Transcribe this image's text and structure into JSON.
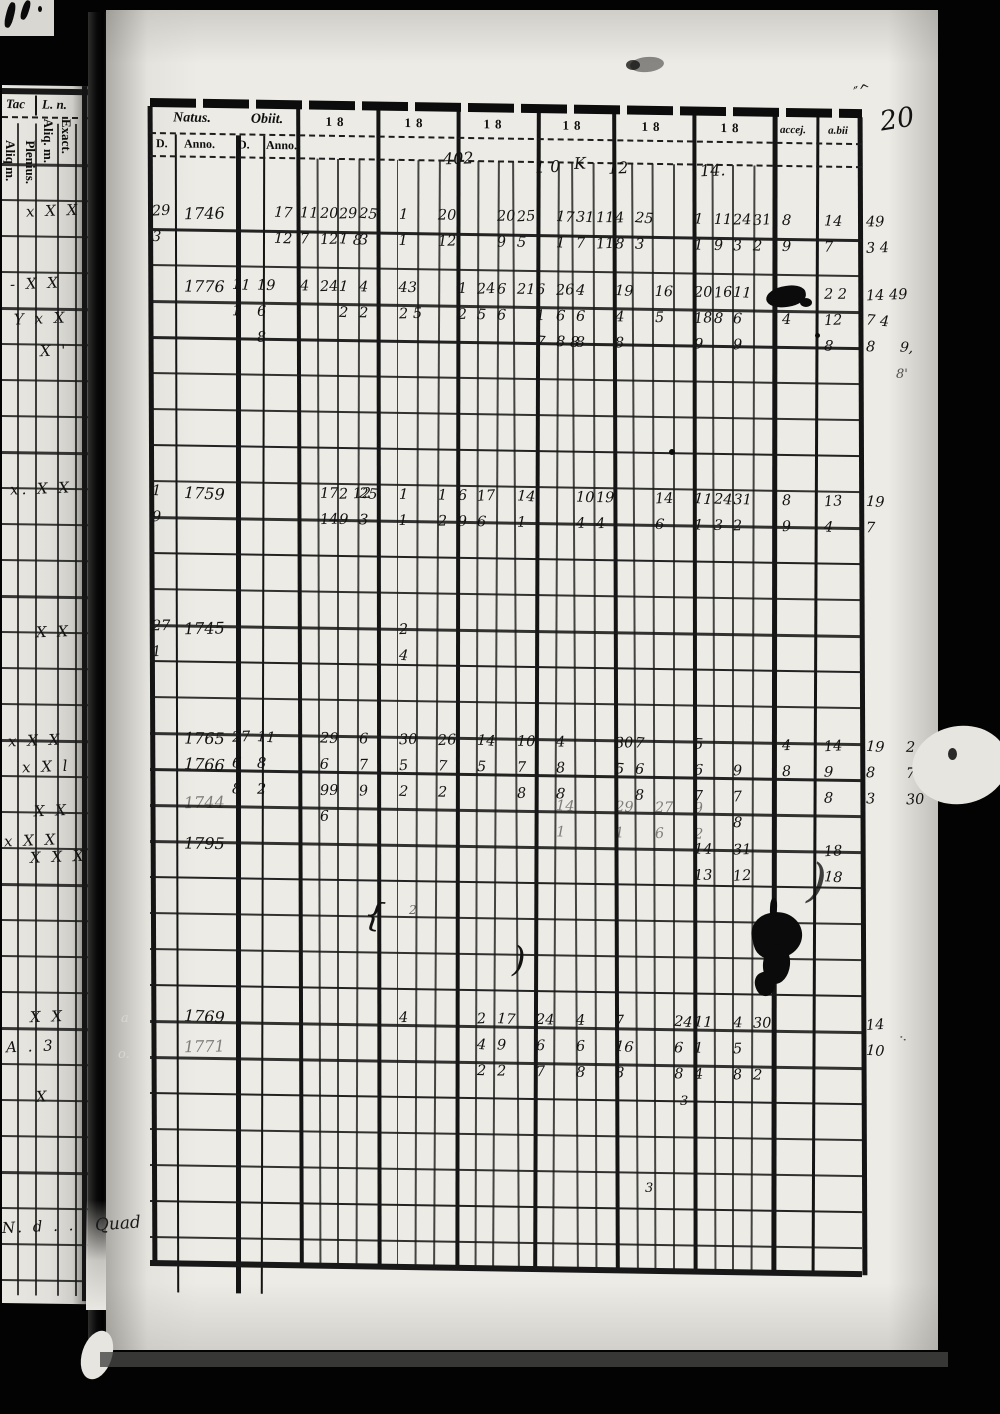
{
  "film": {
    "page_number": "20"
  },
  "left_strip": {
    "header_tac": "Tac",
    "header_ln": "L. n.",
    "rotated_labels": [
      {
        "t": "Exact.",
        "x": 72,
        "y": 33
      },
      {
        "t": "Aliq. m.",
        "x": 54,
        "y": 33
      },
      {
        "t": "Plenius.",
        "x": 36,
        "y": 55
      },
      {
        "t": "Aliq m.",
        "x": 16,
        "y": 55
      }
    ],
    "x_mark_rows": [
      {
        "y": 127,
        "x": 24,
        "t": "x X X"
      },
      {
        "y": 200,
        "x": 8,
        "t": "- X X"
      },
      {
        "y": 235,
        "x": 12,
        "t": "Y x X"
      },
      {
        "y": 267,
        "x": 38,
        "t": "X '"
      },
      {
        "y": 405,
        "x": 8,
        "t": "x. X X"
      },
      {
        "y": 548,
        "x": 34,
        "t": "X X"
      },
      {
        "y": 657,
        "x": 6,
        "t": "x X X"
      },
      {
        "y": 683,
        "x": 20,
        "t": "x X l"
      },
      {
        "y": 727,
        "x": 32,
        "t": "X X"
      },
      {
        "y": 757,
        "x": 2,
        "t": "x X X"
      },
      {
        "y": 773,
        "x": 28,
        "t": "X X X"
      },
      {
        "y": 933,
        "x": 28,
        "t": "X X"
      },
      {
        "y": 963,
        "x": 4,
        "t": "A . 3"
      },
      {
        "y": 1013,
        "x": 34,
        "t": "X"
      },
      {
        "y": 1143,
        "x": 0,
        "t": "N. d . ."
      }
    ],
    "gutter_word": "Quad",
    "gutter_marks": [
      {
        "g": "a",
        "x": 121,
        "y": 1012
      },
      {
        "g": "o.",
        "x": 118,
        "y": 1048
      }
    ]
  },
  "table": {
    "header": {
      "natus": "Natus.",
      "obiit": "Obiit.",
      "d1": "D.",
      "anno1": "Anno.",
      "d2": "D.",
      "anno2": "Anno.",
      "year_cols": [
        "18",
        "18",
        "18",
        "18",
        "18",
        "18"
      ],
      "accej": "accej.",
      "abii": "a.bii"
    },
    "top_annotations": [
      {
        "t": "402",
        "x": 293,
        "y": 48
      },
      {
        "t": "1 0",
        "x": 385,
        "y": 55
      },
      {
        "t": "K",
        "x": 424,
        "y": 51
      },
      {
        "t": "12",
        "x": 458,
        "y": 55
      },
      {
        "t": "14.",
        "x": 550,
        "y": 56
      }
    ],
    "rows": [
      {
        "year": "1746",
        "y": 117,
        "cells": {
          "nD": [
            "29",
            "3"
          ],
          "oA2": [
            "17",
            "12"
          ],
          "s0": [
            "11",
            "7"
          ],
          "s1": [
            "20",
            "12"
          ],
          "s2": [
            "29",
            "1 8"
          ],
          "s3": [
            "25",
            "3"
          ],
          "s5": [
            "1",
            "1"
          ],
          "s7": [
            "20",
            "12"
          ],
          "s10": [
            "20",
            "9"
          ],
          "s11": [
            "25",
            "5"
          ],
          "s13": [
            "17",
            "1"
          ],
          "s14": [
            "31",
            "7"
          ],
          "s15": [
            "11",
            "11"
          ],
          "s16": [
            "4",
            "8"
          ],
          "s17": [
            "25",
            "3"
          ],
          "s20": [
            "1",
            "1"
          ],
          "s21": [
            "11",
            "9"
          ],
          "s22": [
            "24",
            "3"
          ],
          "s23": [
            "31",
            "2"
          ],
          "ac": [
            "8",
            "9"
          ],
          "ab": [
            "14",
            "7"
          ],
          "mR": [
            "49",
            "3 4"
          ]
        }
      },
      {
        "year": "1776",
        "y": 190,
        "cells": {
          "oD": [
            "11",
            "1"
          ],
          "oA": [
            "19",
            "6",
            "8"
          ],
          "s0": [
            "4",
            ""
          ],
          "s1": [
            "24",
            ""
          ],
          "s2": [
            "1",
            "2"
          ],
          "s3": [
            "4",
            "2"
          ],
          "s5": [
            "43",
            "2 5"
          ],
          "s8": [
            "1",
            "2"
          ],
          "s9": [
            "24",
            "5"
          ],
          "s10": [
            "6",
            "6"
          ],
          "s11": [
            "21",
            ""
          ],
          "s12": [
            "6",
            "1",
            "7"
          ],
          "s13": [
            "26",
            "6",
            "8 8"
          ],
          "s14": [
            "4",
            "6",
            "8"
          ],
          "s16": [
            "19",
            "4",
            "8"
          ],
          "s18": [
            "16",
            "5"
          ],
          "s20": [
            "20",
            "18",
            "9"
          ],
          "s21": [
            "16",
            "8"
          ],
          "s22": [
            "11",
            "6",
            "9"
          ],
          "ac": [
            "",
            "4"
          ],
          "ab": [
            "2 2",
            "12",
            "8"
          ],
          "mR": [
            "14 49",
            "7 4",
            "8"
          ]
        }
      },
      {
        "year": "1759",
        "y": 397,
        "cells": {
          "nD": [
            "1",
            "9"
          ],
          "s1": [
            "17",
            "14"
          ],
          "s2": [
            "2 12",
            "9"
          ],
          "s3": [
            "25",
            "3"
          ],
          "s5": [
            "1",
            "1"
          ],
          "s7": [
            "1",
            "2"
          ],
          "s8": [
            "6",
            "9"
          ],
          "s9": [
            "17",
            "6"
          ],
          "s11": [
            "14",
            "1"
          ],
          "s14": [
            "10",
            "4"
          ],
          "s15": [
            "19",
            "4"
          ],
          "s18": [
            "14",
            "6"
          ],
          "s20": [
            "11",
            "1"
          ],
          "s21": [
            "24",
            "3"
          ],
          "s22": [
            "31",
            "2"
          ],
          "ac": [
            "8",
            "9"
          ],
          "ab": [
            "13",
            "4"
          ],
          "mR": [
            "19",
            "7"
          ]
        }
      },
      {
        "year": "1745",
        "y": 532,
        "cells": {
          "nD": [
            "27",
            "1"
          ],
          "s5": [
            "2",
            "4"
          ]
        }
      },
      {
        "year": "1765",
        "y": 642,
        "cells": {
          "oD": [
            "27",
            "6",
            "8"
          ],
          "oA": [
            "11",
            "8",
            "2"
          ],
          "s1": [
            "29",
            "6",
            "99",
            "6"
          ],
          "s3": [
            "6",
            "7",
            "9"
          ],
          "s5": [
            "30",
            "5",
            "2"
          ],
          "s7": [
            "26",
            "7",
            "2"
          ],
          "s9": [
            "14",
            "5"
          ],
          "s11": [
            "10",
            "7",
            "8"
          ],
          "s13": [
            "4",
            "8",
            "8"
          ],
          "s16": [
            "30",
            "5"
          ],
          "s17": [
            "7",
            "6",
            "8"
          ],
          "s20": [
            "5",
            "6",
            "7"
          ],
          "s22": [
            "",
            "9",
            "7",
            "8"
          ],
          "ac": [
            "4",
            "8"
          ],
          "ab": [
            "14",
            "9",
            "8"
          ],
          "mR": [
            "19",
            "8",
            "3"
          ],
          "mR2": [
            "2",
            "7",
            "30"
          ]
        }
      },
      {
        "year": "1766",
        "y": 668,
        "cells": {}
      },
      {
        "year": "1744",
        "y": 706,
        "faint": true,
        "cells": {
          "s13": [
            "14",
            "1"
          ],
          "s16": [
            "29",
            "1"
          ],
          "s18": [
            "27",
            "6"
          ],
          "s20": [
            "9",
            "2"
          ]
        }
      },
      {
        "year": "1795",
        "y": 747,
        "cells": {
          "s20": [
            "14",
            "13"
          ],
          "s22": [
            "31",
            "12"
          ],
          "ab": [
            "18",
            "18"
          ]
        }
      },
      {
        "year": "1769",
        "y": 920,
        "cells": {
          "s5": [
            "4",
            ""
          ],
          "s9": [
            "2",
            "4",
            "2"
          ],
          "s10": [
            "17",
            "9",
            "2"
          ],
          "s12": [
            "24",
            "6",
            "7"
          ],
          "s14": [
            "4",
            "6",
            "8"
          ],
          "s16": [
            "7",
            "16",
            "8"
          ],
          "s19": [
            "24",
            "6",
            "8"
          ],
          "s20": [
            "11",
            "1",
            "4"
          ],
          "s22": [
            "4",
            "5",
            "8"
          ],
          "s23": [
            "30",
            "",
            "2"
          ],
          "mR": [
            "14",
            "10"
          ]
        }
      },
      {
        "year": "1771",
        "y": 950,
        "faint": true,
        "cells": {}
      }
    ]
  },
  "marks": [
    {
      "g": "″^",
      "x": 854,
      "y": 84,
      "s": 14,
      "r": -15
    },
    {
      "g": "9,",
      "x": 900,
      "y": 341,
      "s": 14,
      "r": 5
    },
    {
      "g": "8'",
      "x": 896,
      "y": 368,
      "s": 13,
      "r": 0,
      "o": 0.7
    },
    {
      "g": "{",
      "x": 364,
      "y": 898,
      "s": 33,
      "r": 8
    },
    {
      "g": ")",
      "x": 512,
      "y": 943,
      "s": 35,
      "r": 0
    },
    {
      "g": ")",
      "x": 808,
      "y": 858,
      "s": 47,
      "r": 5,
      "o": 0.8
    },
    {
      "g": "2",
      "x": 409,
      "y": 904,
      "s": 12,
      "r": 0,
      "o": 0.6
    },
    {
      "g": "3",
      "x": 680,
      "y": 1095,
      "s": 13,
      "r": 0
    },
    {
      "g": "3",
      "x": 645,
      "y": 1182,
      "s": 13,
      "r": 0
    },
    {
      "g": "··",
      "x": 898,
      "y": 1032,
      "s": 14,
      "r": 40,
      "o": 0.7
    }
  ],
  "blobs": [
    {
      "x": 752,
      "y": 912,
      "w": 50,
      "h": 46,
      "r": -14,
      "br": "45% 55% 50% 40%"
    },
    {
      "x": 763,
      "y": 944,
      "w": 27,
      "h": 40,
      "r": 6,
      "br": "50%"
    },
    {
      "x": 755,
      "y": 972,
      "w": 20,
      "h": 24,
      "r": -20,
      "br": "50% 40% 55% 45%"
    },
    {
      "x": 770,
      "y": 898,
      "w": 7,
      "h": 20,
      "r": 3,
      "br": "40%"
    },
    {
      "x": 766,
      "y": 286,
      "w": 40,
      "h": 21,
      "r": -8,
      "br": "55% 45% 50% 50%"
    },
    {
      "x": 800,
      "y": 298,
      "w": 12,
      "h": 9,
      "r": 0,
      "br": "50%"
    },
    {
      "x": 630,
      "y": 57,
      "w": 34,
      "h": 15,
      "r": -5,
      "br": "50%",
      "o": 0.45
    },
    {
      "x": 626,
      "y": 60,
      "w": 14,
      "h": 10,
      "r": 0,
      "br": "50%",
      "o": 0.75
    },
    {
      "x": 669,
      "y": 449,
      "w": 6,
      "h": 6,
      "r": 0,
      "br": "50%"
    },
    {
      "x": 815,
      "y": 333,
      "w": 5,
      "h": 5,
      "r": 0,
      "br": "50%"
    },
    {
      "x": 6,
      "y": 2,
      "w": 8,
      "h": 26,
      "r": 14,
      "br": "40%"
    },
    {
      "x": 22,
      "y": 0,
      "w": 7,
      "h": 20,
      "r": 18,
      "br": "40%"
    },
    {
      "x": 38,
      "y": 6,
      "w": 4,
      "h": 6,
      "r": 0,
      "br": "50%"
    }
  ]
}
